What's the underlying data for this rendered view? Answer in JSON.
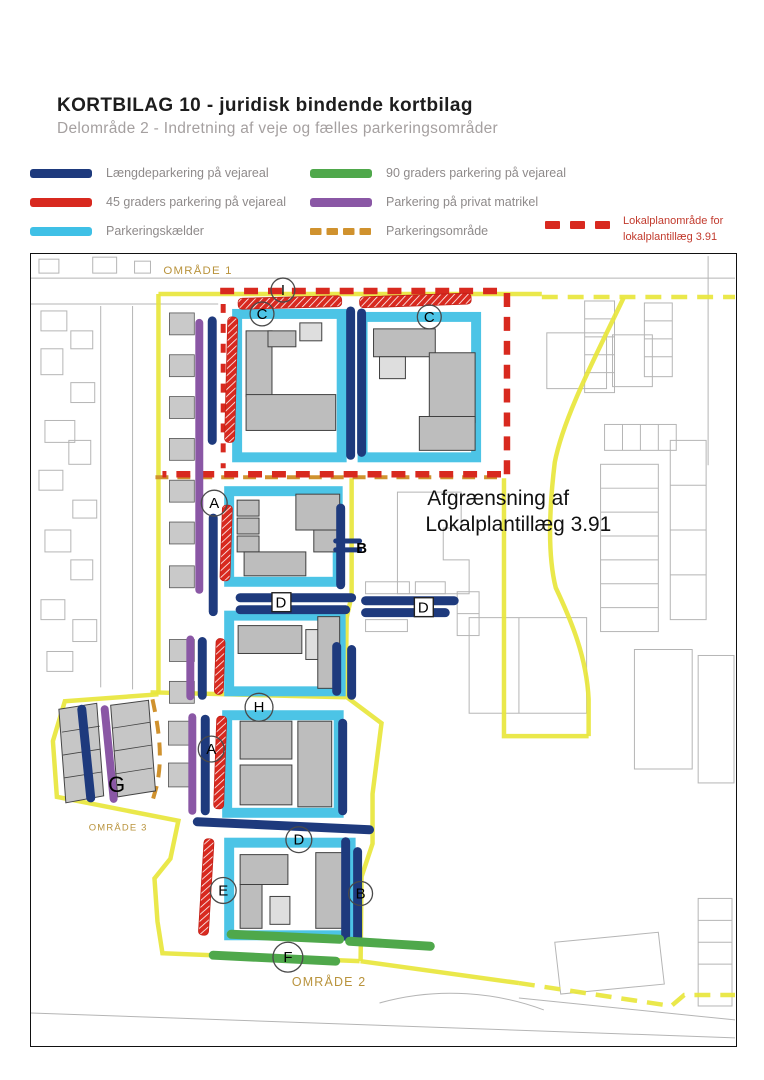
{
  "header": {
    "title": "KORTBILAG 10 - juridisk bindende kortbilag",
    "subtitle": "Delområde 2 -  Indretning af veje og fælles parkeringsområder"
  },
  "legend": {
    "items": [
      {
        "label": "Længdeparkering på vejareal",
        "color": "#1e3a7d",
        "style": "solid"
      },
      {
        "label": "45 graders parkering på vejareal",
        "color": "#d8291f",
        "style": "solid"
      },
      {
        "label": "Parkeringskælder",
        "color": "#3fc0e6",
        "style": "solid"
      },
      {
        "label": "90 graders parkering på vejareal",
        "color": "#4fa84b",
        "style": "solid"
      },
      {
        "label": "Parkering på privat matrikel",
        "color": "#8a57a5",
        "style": "solid"
      },
      {
        "label": "Parkeringsområde",
        "color": "#d0922e",
        "style": "dashed"
      }
    ],
    "lokalplan": {
      "label_line1": "Lokalplanområde for",
      "label_line2": "lokalplantillæg 3.91",
      "color": "#d8291f"
    }
  },
  "map": {
    "area_labels": {
      "omrade1": "OMRÅDE 1",
      "omrade2": "OMRÅDE 2",
      "omrade3": "OMRÅDE 3"
    },
    "annotation": {
      "line1": "Afgrænsning af",
      "line2": "Lokalplantillæg 3.91"
    },
    "markers": [
      {
        "letter": "I"
      },
      {
        "letter": "C"
      },
      {
        "letter": "C"
      },
      {
        "letter": "A"
      },
      {
        "letter": "B"
      },
      {
        "letter": "D"
      },
      {
        "letter": "D"
      },
      {
        "letter": "H"
      },
      {
        "letter": "A"
      },
      {
        "letter": "D"
      },
      {
        "letter": "E"
      },
      {
        "letter": "B"
      },
      {
        "letter": "F"
      },
      {
        "letter": "G"
      }
    ],
    "colors": {
      "boundary_yellow": "#e8e63c",
      "lokalplan_red": "#d8291f",
      "parking_area_orange": "#d0922e",
      "building_gray": "#bdbdbd"
    }
  }
}
